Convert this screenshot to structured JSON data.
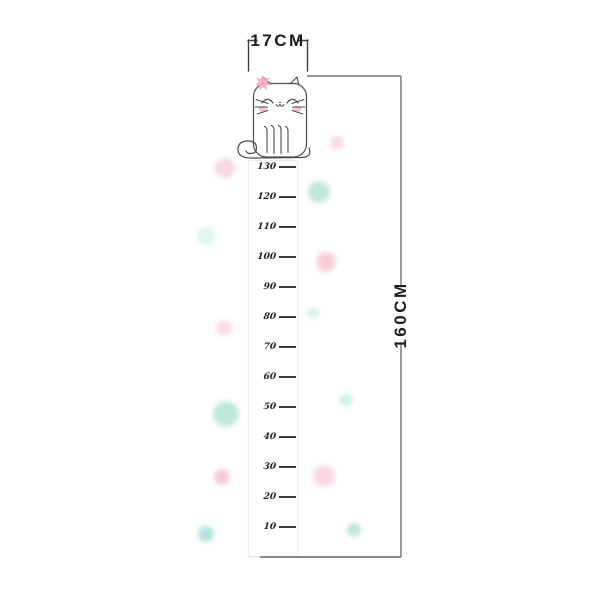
{
  "dimensions": {
    "width_label": "17CM",
    "height_label": "160CM"
  },
  "ruler": {
    "values": [
      "130",
      "120",
      "110",
      "100",
      "90",
      "80",
      "70",
      "60",
      "50",
      "40",
      "30",
      "20",
      "10"
    ]
  },
  "decor": {
    "colors": {
      "pink": "#f7ccd6",
      "teal": "#bee7da",
      "flower_pink": "#f5afc6",
      "cheek_pink": "#f6bfcc"
    },
    "dots": [
      {
        "x": 225,
        "y": 168,
        "r": 10,
        "color": "#f7ccd6",
        "opacity": 0.75
      },
      {
        "x": 206,
        "y": 236,
        "r": 9,
        "color": "#bee7da",
        "opacity": 0.45
      },
      {
        "x": 224,
        "y": 328,
        "r": 8,
        "color": "#f7ccd6",
        "opacity": 0.65
      },
      {
        "x": 226,
        "y": 414,
        "r": 13,
        "color": "#b7e4d6",
        "opacity": 0.85
      },
      {
        "x": 222,
        "y": 477,
        "r": 8,
        "color": "#f6c4d0",
        "opacity": 0.85
      },
      {
        "x": 206,
        "y": 534,
        "r": 8,
        "color": "#a9dfd5",
        "opacity": 0.85
      },
      {
        "x": 337,
        "y": 143,
        "r": 7,
        "color": "#f7ccd6",
        "opacity": 0.7
      },
      {
        "x": 319,
        "y": 192,
        "r": 11,
        "color": "#b7e4d6",
        "opacity": 0.85
      },
      {
        "x": 326,
        "y": 262,
        "r": 10,
        "color": "#f6c4d0",
        "opacity": 0.8
      },
      {
        "x": 313,
        "y": 313,
        "r": 6,
        "color": "#bee7da",
        "opacity": 0.5
      },
      {
        "x": 346,
        "y": 400,
        "r": 7,
        "color": "#bee7da",
        "opacity": 0.65
      },
      {
        "x": 324,
        "y": 476,
        "r": 11,
        "color": "#f7ccd6",
        "opacity": 0.75
      },
      {
        "x": 354,
        "y": 530,
        "r": 7,
        "color": "#aee0d3",
        "opacity": 0.75
      }
    ]
  }
}
